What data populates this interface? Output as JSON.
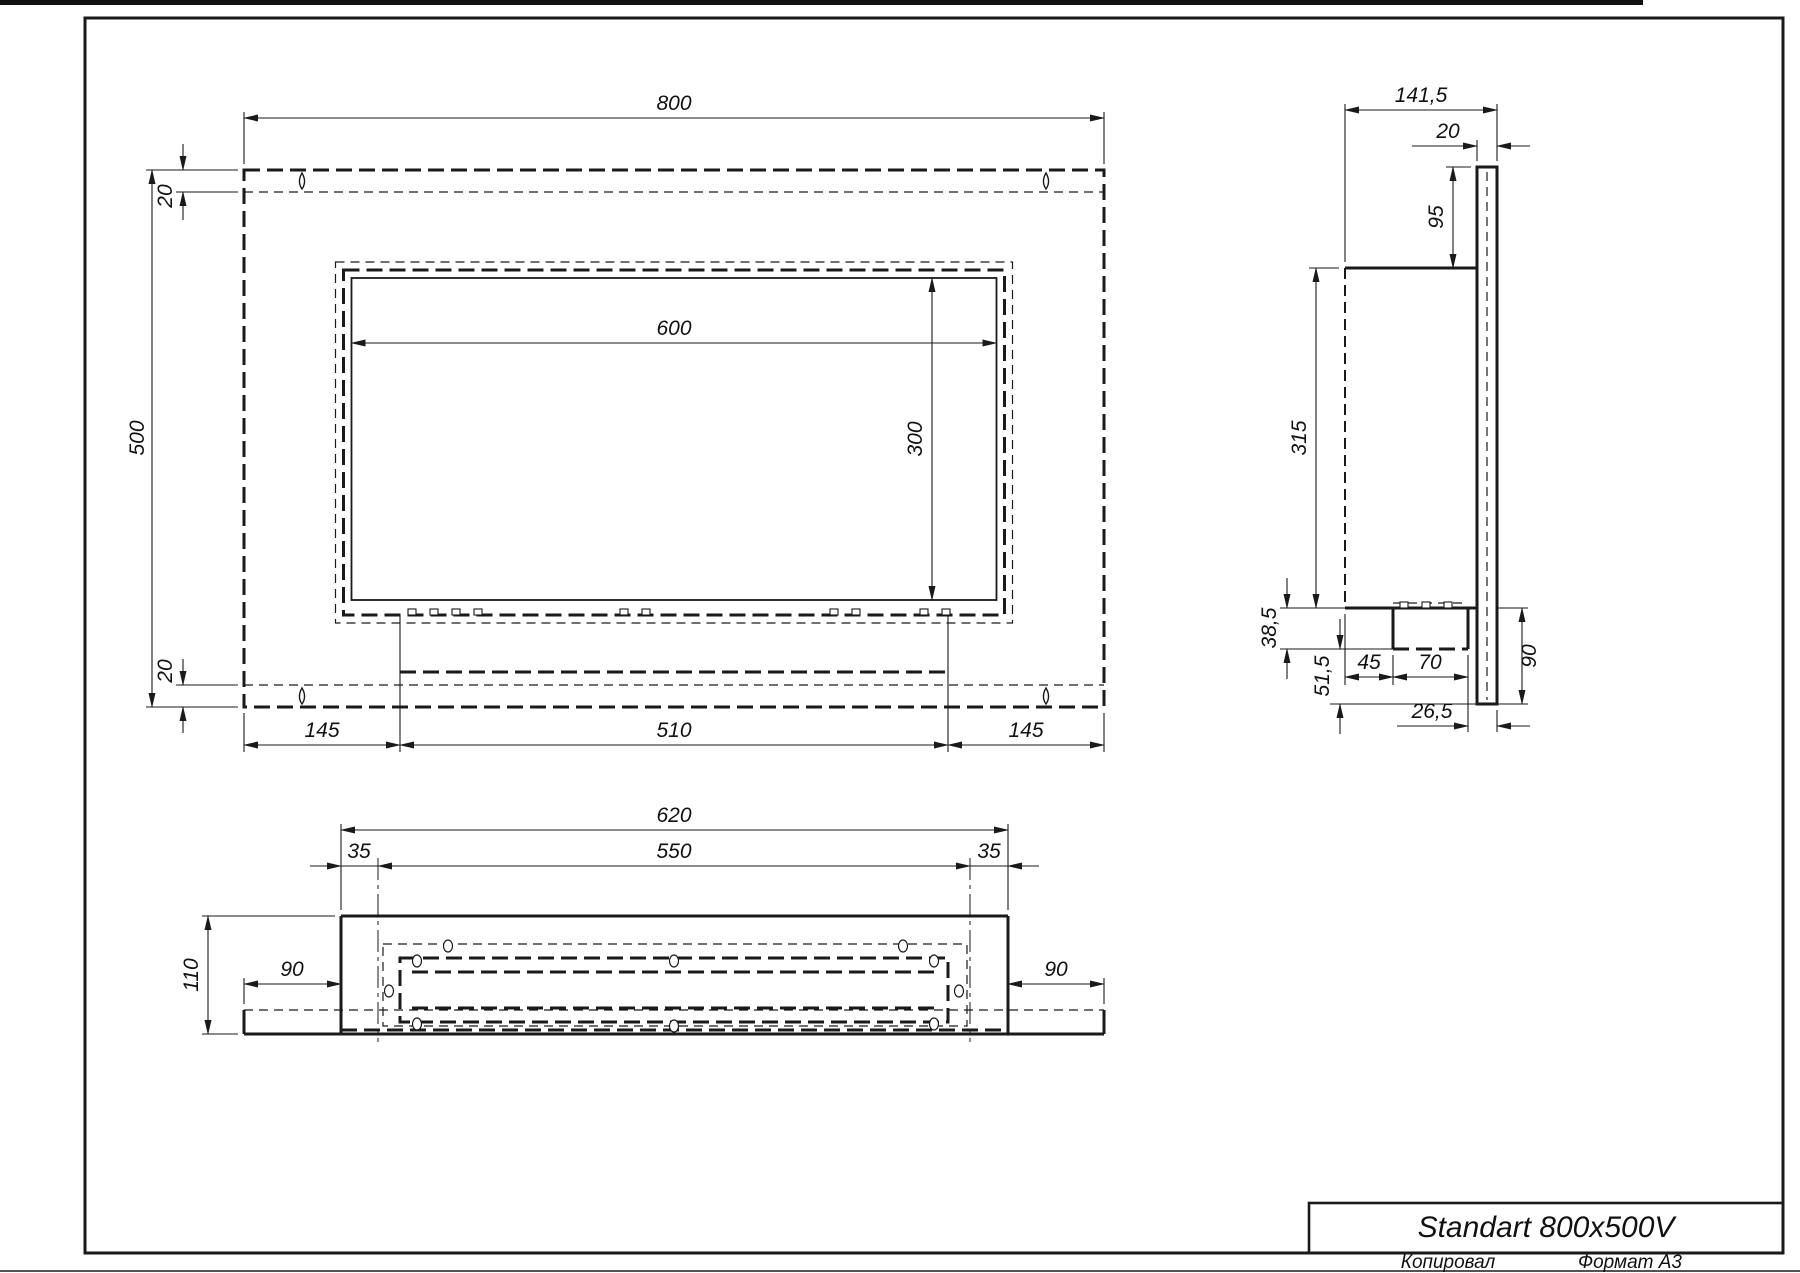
{
  "front": {
    "width": "800",
    "height": "500",
    "inset_top": "20",
    "inset_bottom": "20",
    "opening_width": "600",
    "opening_height": "300",
    "bottom_left": "145",
    "bottom_mid": "510",
    "bottom_right": "145"
  },
  "side": {
    "depth": "141,5",
    "plate_thickness": "20",
    "top_offset": "95",
    "body_height": "315",
    "tray_depth": "38,5",
    "below_tray": "51,5",
    "tray_offset": "45",
    "tray_width": "70",
    "plate_below_body": "90",
    "back_offset": "26,5"
  },
  "bottom": {
    "width": "620",
    "inner_width": "550",
    "margin_left": "35",
    "margin_right": "35",
    "height": "110",
    "flange_left": "90",
    "flange_right": "90"
  },
  "titleblock": {
    "title": "Standart 800x500V",
    "copied": "Копировал",
    "format": "Формат А3"
  }
}
